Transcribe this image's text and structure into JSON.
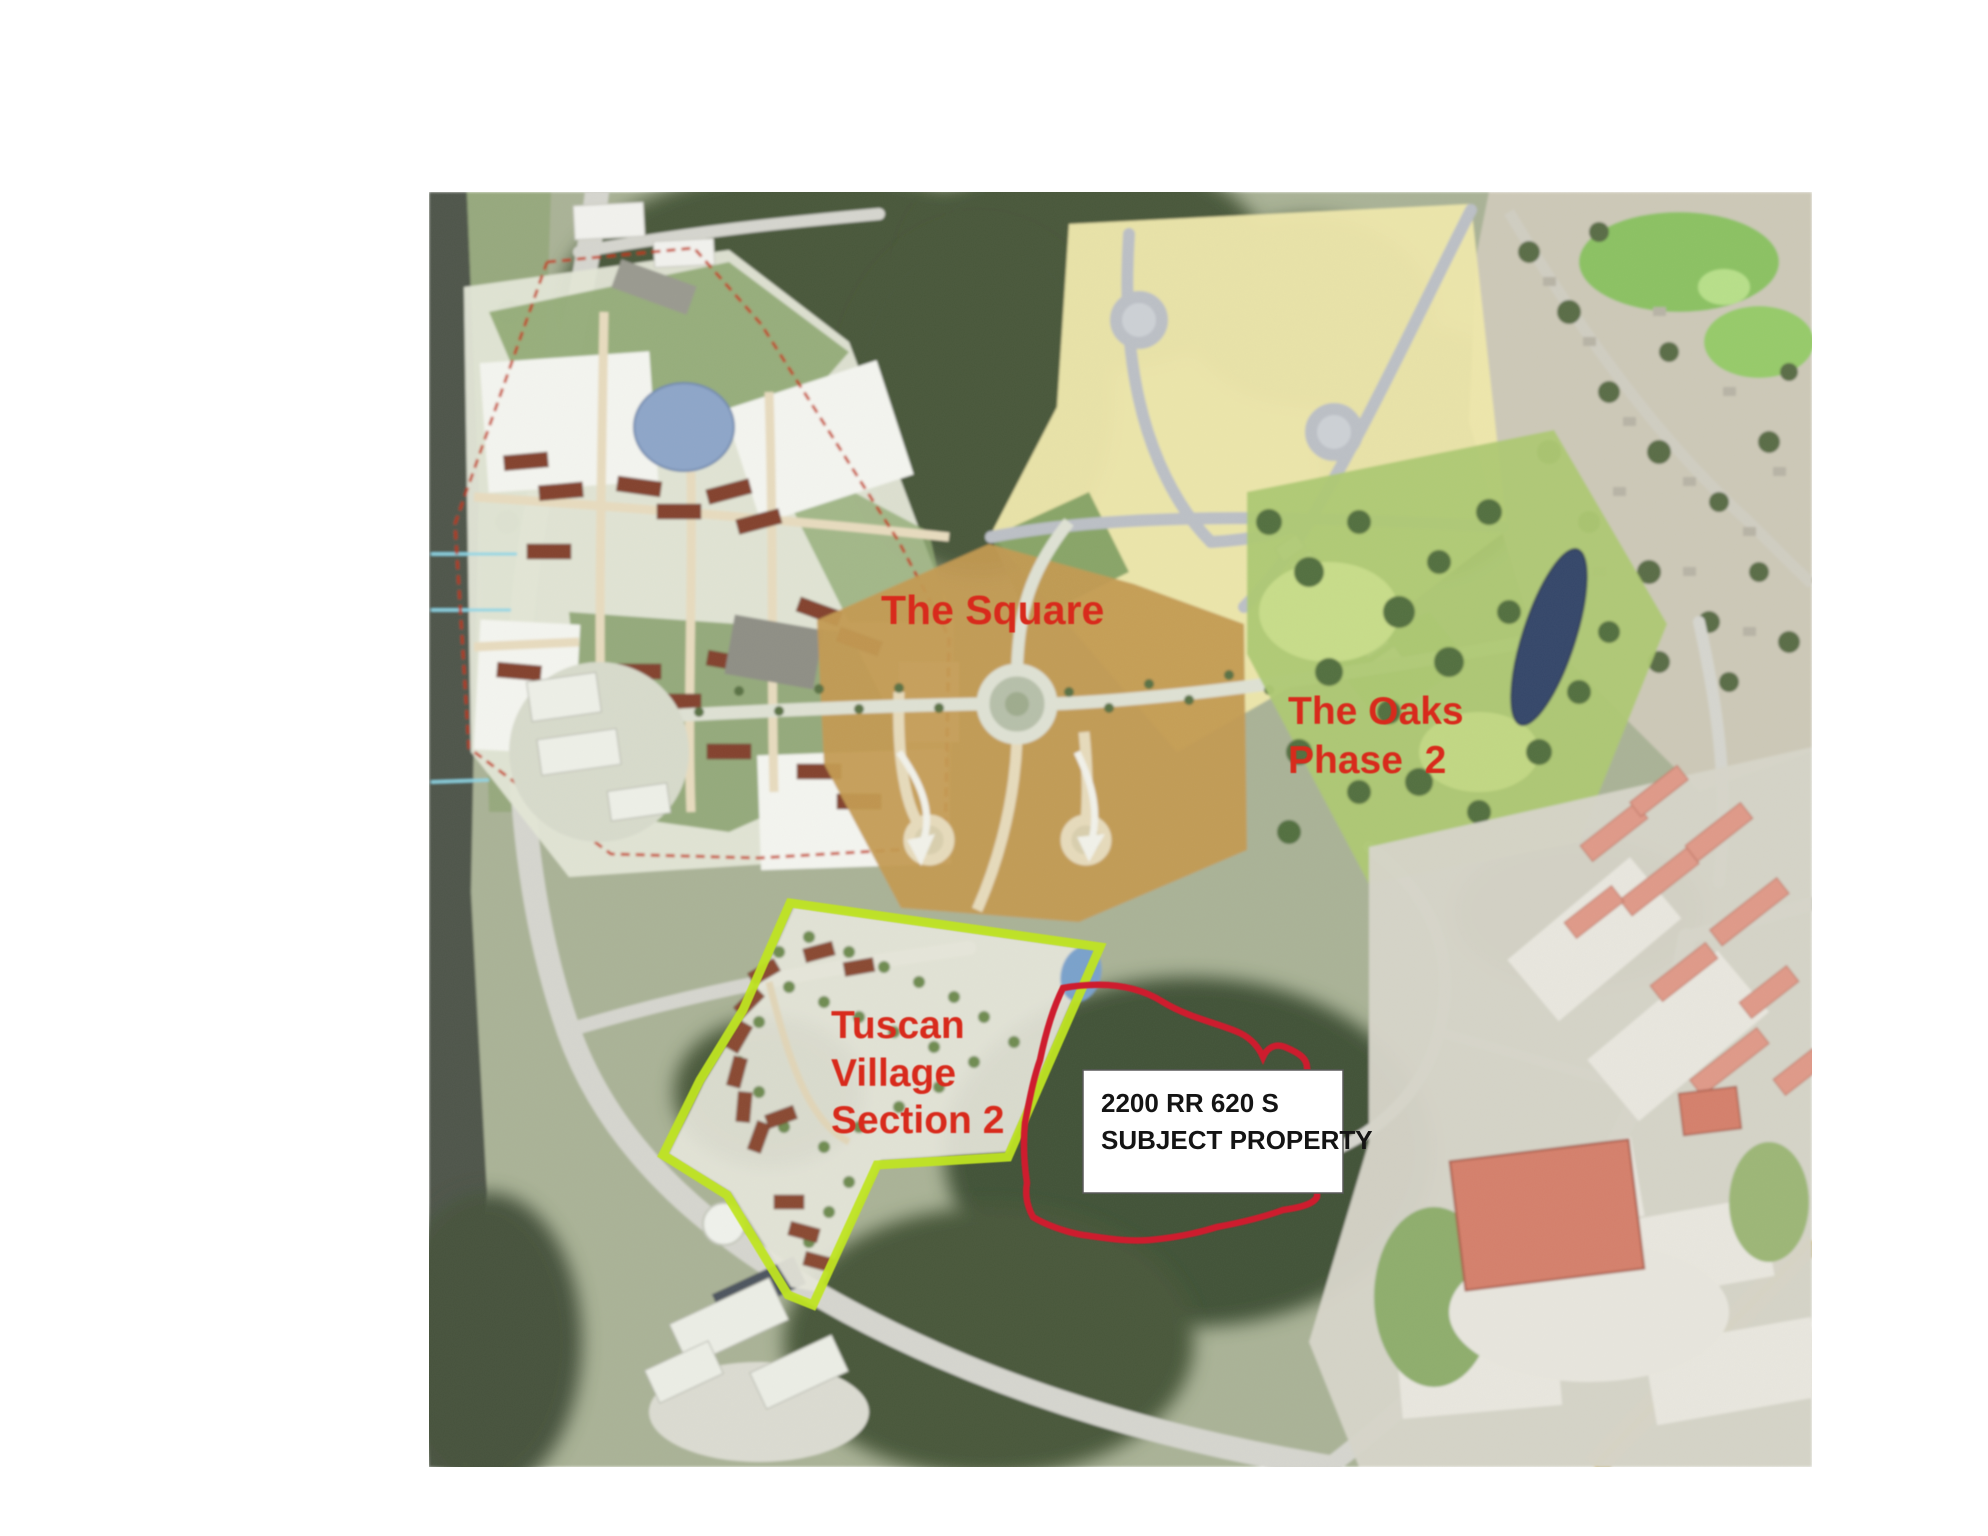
{
  "map_figure": {
    "annotations": {
      "the_square": "The Square",
      "the_oaks_line1": "The Oaks",
      "the_oaks_line2": "Phase  2",
      "tuscan_line1": "Tuscan",
      "tuscan_line2": "Village",
      "tuscan_line3": "Section 2"
    },
    "callout": {
      "line1": "2200 RR 620 S",
      "line2": "SUBJECT PROPERTY"
    },
    "colors": {
      "annotation_red": "#d8291b",
      "tuscan_outline_lime": "#bfe420",
      "subject_outline_red": "#ce1f2d",
      "square_boundary_dashed_red": "#c23318",
      "oaks_parcel_yellow": "#eee7ab",
      "center_parcel_orange": "#c49a52",
      "park_green": "#aec973",
      "pond_blue": "#8ea6c9",
      "park_pond_navy": "#36466a",
      "forest_green": "#49593a",
      "road_gray": "#d6d6cf",
      "callout_bg": "#ffffff",
      "callout_text": "#141414"
    }
  }
}
